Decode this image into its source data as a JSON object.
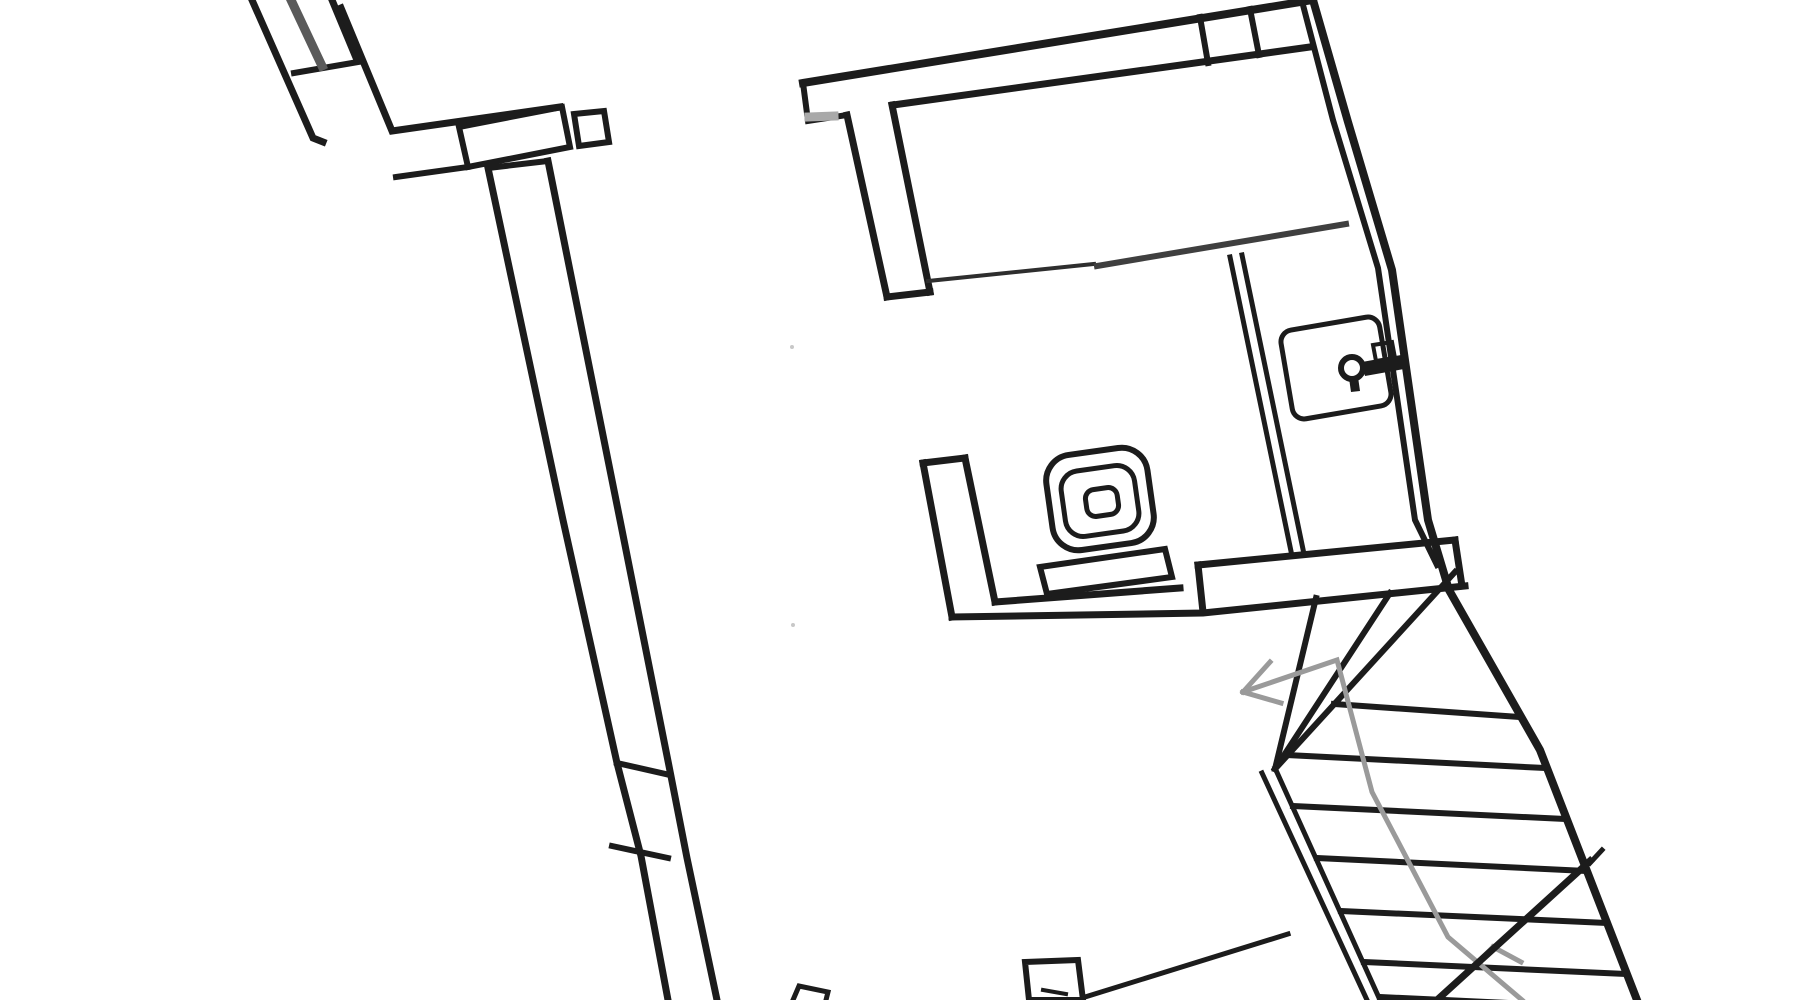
{
  "canvas": {
    "width": 1800,
    "height": 1000,
    "background": "#ffffff"
  },
  "palette": {
    "wall": "#1c1c1c",
    "gray_window": "#5a5a5a",
    "light_gray": "#a9a9a9",
    "walk": "#9a9a9a",
    "partition": "#3f3f3f",
    "partition_thin": "#2e2e2e",
    "speck": "#c8c8c8"
  },
  "elements": [
    {
      "name": "nw-wall-outer",
      "type": "polyline",
      "points": [
        [
          252,
          0
        ],
        [
          313,
          138
        ],
        [
          323,
          142
        ]
      ],
      "w": 7
    },
    {
      "name": "nw-wall-inner",
      "type": "line",
      "p": [
        332,
        0,
        357,
        60
      ],
      "w": 7
    },
    {
      "name": "nw-wall-cap",
      "type": "line",
      "p": [
        294,
        73,
        358,
        62
      ],
      "w": 6
    },
    {
      "name": "nw-window",
      "type": "line",
      "p": [
        291,
        0,
        322,
        66
      ],
      "w": 9,
      "color": "gray_window"
    },
    {
      "name": "entry-wall-top",
      "type": "polyline",
      "points": [
        [
          341,
          8
        ],
        [
          392,
          131
        ],
        [
          560,
          107
        ]
      ],
      "w": 7
    },
    {
      "name": "entry-wall-bottom",
      "type": "line",
      "p": [
        396,
        177,
        468,
        167
      ],
      "w": 6
    },
    {
      "name": "entry-window-box",
      "type": "polygon",
      "points": [
        [
          459,
          127
        ],
        [
          562,
          107
        ],
        [
          570,
          147
        ],
        [
          468,
          167
        ]
      ],
      "w": 6
    },
    {
      "name": "entry-pillar-box",
      "type": "polygon",
      "points": [
        [
          574,
          114
        ],
        [
          604,
          111
        ],
        [
          609,
          142
        ],
        [
          579,
          146
        ]
      ],
      "w": 6
    },
    {
      "name": "west-wall-cap",
      "type": "line",
      "p": [
        488,
        168,
        548,
        161
      ],
      "w": 6
    },
    {
      "name": "west-wall-left",
      "type": "polyline",
      "points": [
        [
          488,
          168
        ],
        [
          563,
          520
        ],
        [
          617,
          763
        ],
        [
          641,
          856
        ],
        [
          668,
          1000
        ]
      ],
      "w": 7
    },
    {
      "name": "west-wall-right",
      "type": "polyline",
      "points": [
        [
          548,
          161
        ],
        [
          620,
          520
        ],
        [
          669,
          766
        ],
        [
          687,
          858
        ],
        [
          717,
          1000
        ]
      ],
      "w": 7
    },
    {
      "name": "west-wall-tick-1",
      "type": "line",
      "p": [
        617,
        763,
        670,
        775
      ],
      "w": 6
    },
    {
      "name": "west-wall-tick-2",
      "type": "line",
      "p": [
        612,
        846,
        668,
        858
      ],
      "w": 6
    },
    {
      "name": "north-wall-outer",
      "type": "line",
      "p": [
        803,
        83,
        1313,
        0
      ],
      "w": 8
    },
    {
      "name": "north-wall-inner",
      "type": "line",
      "p": [
        893,
        105,
        1310,
        47
      ],
      "w": 7
    },
    {
      "name": "north-wall-left-cap",
      "type": "polyline",
      "points": [
        [
          803,
          83
        ],
        [
          808,
          121
        ],
        [
          847,
          115
        ]
      ],
      "w": 6
    },
    {
      "name": "north-wall-gray-stub",
      "type": "line",
      "p": [
        809,
        117,
        834,
        116
      ],
      "w": 9,
      "color": "light_gray"
    },
    {
      "name": "t-stem-left",
      "type": "line",
      "p": [
        847,
        115,
        887,
        297
      ],
      "w": 7
    },
    {
      "name": "t-stem-right",
      "type": "line",
      "p": [
        892,
        105,
        930,
        292
      ],
      "w": 7
    },
    {
      "name": "t-stem-cap",
      "type": "line",
      "p": [
        887,
        297,
        930,
        292
      ],
      "w": 7
    },
    {
      "name": "north-wall-tick-1",
      "type": "line",
      "p": [
        1200,
        17,
        1208,
        63
      ],
      "w": 6
    },
    {
      "name": "north-wall-tick-2",
      "type": "line",
      "p": [
        1250,
        9,
        1259,
        55
      ],
      "w": 6
    },
    {
      "name": "east-wall-outer",
      "type": "polyline",
      "points": [
        [
          1313,
          0
        ],
        [
          1348,
          122
        ],
        [
          1392,
          270
        ],
        [
          1428,
          520
        ],
        [
          1449,
          590
        ],
        [
          1540,
          750
        ],
        [
          1637,
          1000
        ]
      ],
      "w": 8
    },
    {
      "name": "east-wall-inner",
      "type": "polyline",
      "points": [
        [
          1303,
          5
        ],
        [
          1333,
          120
        ],
        [
          1378,
          268
        ],
        [
          1415,
          520
        ],
        [
          1437,
          565
        ]
      ],
      "w": 6
    },
    {
      "name": "partition-line-left",
      "type": "line",
      "p": [
        928,
        281,
        1094,
        264
      ],
      "w": 4,
      "color": "partition_thin"
    },
    {
      "name": "partition-line-right",
      "type": "line",
      "p": [
        1097,
        266,
        1346,
        224
      ],
      "w": 6,
      "color": "partition"
    },
    {
      "name": "bath-wall-left-line",
      "type": "line",
      "p": [
        1230,
        257,
        1292,
        556
      ],
      "w": 5
    },
    {
      "name": "bath-wall-right-line",
      "type": "line",
      "p": [
        1242,
        255,
        1304,
        554
      ],
      "w": 5
    },
    {
      "name": "south-wall-l-left",
      "type": "line",
      "p": [
        923,
        463,
        952,
        617
      ],
      "w": 7
    },
    {
      "name": "south-wall-l-right",
      "type": "line",
      "p": [
        965,
        458,
        995,
        602
      ],
      "w": 7
    },
    {
      "name": "south-wall-l-cap",
      "type": "line",
      "p": [
        923,
        463,
        965,
        458
      ],
      "w": 7
    },
    {
      "name": "south-wall-bottom",
      "type": "polyline",
      "points": [
        [
          952,
          617
        ],
        [
          1203,
          613
        ],
        [
          1465,
          586
        ]
      ],
      "w": 7
    },
    {
      "name": "south-wall-top-left",
      "type": "line",
      "p": [
        995,
        602,
        1180,
        588
      ],
      "w": 7
    },
    {
      "name": "stairwell-top-wall",
      "type": "line",
      "p": [
        1198,
        565,
        1455,
        540
      ],
      "w": 7
    },
    {
      "name": "stairwell-top-wall-cap",
      "type": "line",
      "p": [
        1198,
        565,
        1203,
        612
      ],
      "w": 7
    },
    {
      "name": "stairwell-top-wall-right-cap",
      "type": "line",
      "p": [
        1455,
        540,
        1462,
        586
      ],
      "w": 7
    },
    {
      "name": "toilet-bowl-outer",
      "type": "rrect",
      "cx": 1100,
      "cy": 499,
      "wd": 102,
      "ht": 96,
      "rx": 26,
      "rot": -8,
      "w": 6
    },
    {
      "name": "toilet-bowl-inner",
      "type": "rrect",
      "cx": 1100,
      "cy": 501,
      "wd": 74,
      "ht": 66,
      "rx": 18,
      "rot": -8,
      "w": 5
    },
    {
      "name": "toilet-drain",
      "type": "rrect",
      "cx": 1102,
      "cy": 502,
      "wd": 32,
      "ht": 27,
      "rx": 9,
      "rot": -8,
      "w": 5
    },
    {
      "name": "toilet-cistern",
      "type": "polygon",
      "points": [
        [
          1040,
          567
        ],
        [
          1165,
          549
        ],
        [
          1172,
          577
        ],
        [
          1047,
          594
        ]
      ],
      "w": 6
    },
    {
      "name": "door-leaf",
      "type": "rrect",
      "cx": 1336,
      "cy": 368,
      "wd": 100,
      "ht": 90,
      "rx": 12,
      "rot": -9.7,
      "w": 5
    },
    {
      "name": "door-knob-ring",
      "type": "circle",
      "cx": 1352,
      "cy": 368,
      "r": 11,
      "w": 6
    },
    {
      "name": "door-knob-tail",
      "type": "polygon",
      "points": [
        [
          1349,
          378
        ],
        [
          1358,
          377
        ],
        [
          1360,
          391
        ],
        [
          1351,
          392
        ]
      ],
      "fill": "wall"
    },
    {
      "name": "door-handle-bar",
      "type": "polygon",
      "points": [
        [
          1362,
          362
        ],
        [
          1401,
          355
        ],
        [
          1404,
          369
        ],
        [
          1365,
          376
        ]
      ],
      "fill": "wall"
    },
    {
      "name": "door-strike-plate",
      "type": "polygon",
      "points": [
        [
          1373,
          345
        ],
        [
          1392,
          342
        ],
        [
          1395,
          358
        ],
        [
          1376,
          361
        ]
      ],
      "w": 4
    },
    {
      "name": "stair-stringer-left",
      "type": "line",
      "p": [
        1262,
        773,
        1367,
        1000
      ],
      "w": 5
    },
    {
      "name": "stair-stringer-right",
      "type": "line",
      "p": [
        1275,
        768,
        1380,
        1000
      ],
      "w": 5
    },
    {
      "name": "stair-winder-1",
      "type": "line",
      "p": [
        1275,
        769,
        1316,
        598
      ],
      "w": 6
    },
    {
      "name": "stair-winder-2",
      "type": "line",
      "p": [
        1275,
        769,
        1390,
        593
      ],
      "w": 6
    },
    {
      "name": "stair-corner-diagonal",
      "type": "line",
      "p": [
        1275,
        769,
        1455,
        572
      ],
      "w": 6
    },
    {
      "name": "stair-tread-1",
      "type": "line",
      "p": [
        1334,
        704,
        1520,
        717
      ],
      "w": 6
    },
    {
      "name": "stair-tread-2",
      "type": "line",
      "p": [
        1287,
        755,
        1545,
        768
      ],
      "w": 6
    },
    {
      "name": "stair-tread-3",
      "type": "line",
      "p": [
        1293,
        806,
        1565,
        819
      ],
      "w": 6
    },
    {
      "name": "stair-tread-4",
      "type": "line",
      "p": [
        1317,
        858,
        1586,
        871
      ],
      "w": 6
    },
    {
      "name": "stair-tread-5",
      "type": "line",
      "p": [
        1341,
        911,
        1607,
        923
      ],
      "w": 6
    },
    {
      "name": "stair-tread-6",
      "type": "line",
      "p": [
        1364,
        962,
        1626,
        974
      ],
      "w": 6
    },
    {
      "name": "stair-tread-7",
      "type": "line",
      "p": [
        1380,
        997,
        1637,
        1009
      ],
      "w": 6
    },
    {
      "name": "stair-walk-line",
      "type": "polyline",
      "points": [
        [
          1243,
          692
        ],
        [
          1337,
          660
        ],
        [
          1372,
          792
        ],
        [
          1448,
          937
        ],
        [
          1522,
          1000
        ]
      ],
      "w": 5,
      "color": "walk"
    },
    {
      "name": "walk-arrow-barb-up",
      "type": "line",
      "p": [
        1243,
        692,
        1270,
        662
      ],
      "w": 5,
      "color": "walk"
    },
    {
      "name": "walk-arrow-barb-down",
      "type": "line",
      "p": [
        1243,
        692,
        1281,
        703
      ],
      "w": 5,
      "color": "walk"
    },
    {
      "name": "walk-barb-lower-1",
      "type": "line",
      "p": [
        1493,
        947,
        1462,
        978
      ],
      "w": 5,
      "color": "walk"
    },
    {
      "name": "walk-barb-lower-2",
      "type": "line",
      "p": [
        1493,
        947,
        1521,
        962
      ],
      "w": 5,
      "color": "walk"
    },
    {
      "name": "stair-break-hook",
      "type": "line",
      "p": [
        1602,
        850,
        1590,
        863
      ],
      "w": 5
    },
    {
      "name": "stair-break-line",
      "type": "line",
      "p": [
        1590,
        861,
        1437,
        1000
      ],
      "w": 7
    },
    {
      "name": "stair-lower-edge",
      "type": "line",
      "p": [
        1085,
        997,
        1288,
        934
      ],
      "w": 5
    },
    {
      "name": "stair-pillar",
      "type": "polygon",
      "points": [
        [
          1025,
          962
        ],
        [
          1078,
          960
        ],
        [
          1083,
          1000
        ],
        [
          1029,
          1000
        ]
      ],
      "w": 6
    },
    {
      "name": "stair-pillar-mark",
      "type": "line",
      "p": [
        1043,
        990,
        1066,
        994
      ],
      "w": 4
    },
    {
      "name": "south-stub-wall",
      "type": "polyline",
      "points": [
        [
          793,
          1000
        ],
        [
          799,
          986
        ],
        [
          828,
          992
        ],
        [
          826,
          1000
        ]
      ],
      "w": 5
    },
    {
      "name": "ink-speck-1",
      "type": "circle",
      "cx": 792,
      "cy": 347,
      "r": 2,
      "fill": "speck"
    },
    {
      "name": "ink-speck-2",
      "type": "circle",
      "cy": 625,
      "cx": 793,
      "r": 2,
      "fill": "speck"
    }
  ]
}
